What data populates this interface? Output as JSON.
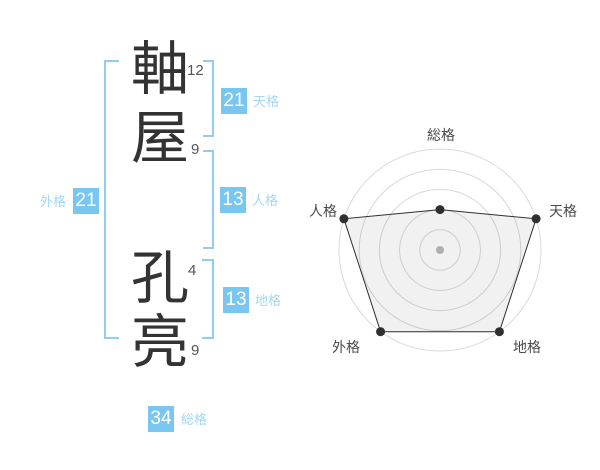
{
  "name": {
    "chars": [
      {
        "char": "軸",
        "strokes": "12"
      },
      {
        "char": "屋",
        "strokes": "9"
      },
      {
        "char": "孔",
        "strokes": "4"
      },
      {
        "char": "亮",
        "strokes": "9"
      }
    ]
  },
  "gokaku": {
    "tenkaku": {
      "value": "21",
      "label": "天格"
    },
    "jinkaku": {
      "value": "13",
      "label": "人格"
    },
    "chikaku": {
      "value": "13",
      "label": "地格"
    },
    "gaikaku": {
      "value": "21",
      "label": "外格"
    },
    "soukaku": {
      "value": "34",
      "label": "総格"
    }
  },
  "colors": {
    "box_bg": "#79C6F1",
    "box_text": "#FFFFFF",
    "label_blue": "#A3D6F5",
    "bracket_blue": "#8FCDF4",
    "kanji": "#333333",
    "strokes_text": "#555555"
  },
  "chart_data": {
    "type": "radar",
    "categories": [
      "総格",
      "天格",
      "地格",
      "外格",
      "人格"
    ],
    "values": [
      2,
      5,
      5,
      5,
      5
    ],
    "scale_max": 5,
    "rings": 5,
    "start_angle_deg": 90,
    "direction": "clockwise",
    "grid_color": "#D9D9D9",
    "center_dot_color": "#BBBBBB",
    "line_color": "#2F2F2F",
    "point_color": "#2F2F2F",
    "fill_color": "rgba(0,0,0,0.055)",
    "label_color": "#4A4A4A",
    "legend_position": "none",
    "title": ""
  }
}
